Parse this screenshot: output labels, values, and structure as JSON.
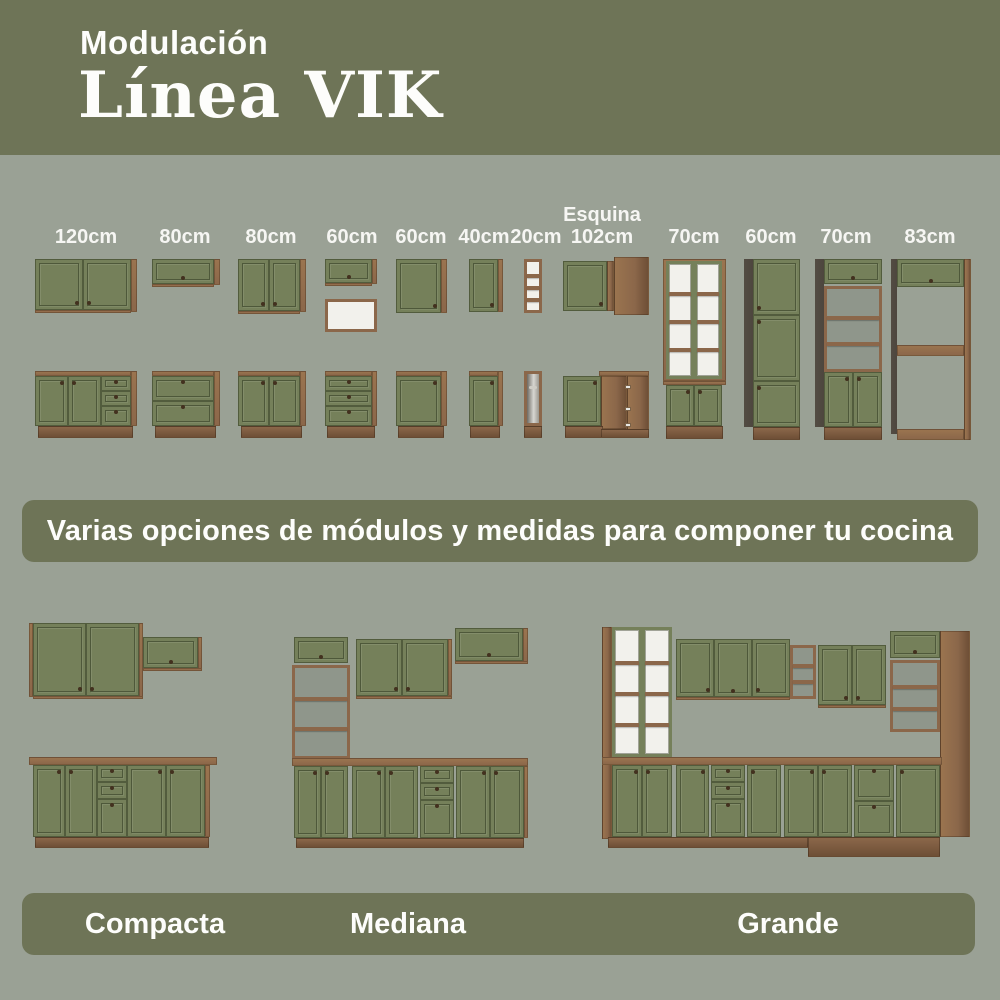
{
  "header": {
    "kicker": "Modulación",
    "title": "Línea VIK"
  },
  "modules": {
    "items": [
      {
        "label": "120cm"
      },
      {
        "label": "80cm"
      },
      {
        "label": "80cm"
      },
      {
        "label": "60cm"
      },
      {
        "label": "60cm"
      },
      {
        "label": "40cm"
      },
      {
        "label": "20cm"
      },
      {
        "label_top": "Esquina",
        "label": "102cm"
      },
      {
        "label": "70cm"
      },
      {
        "label": "60cm"
      },
      {
        "label": "70cm"
      },
      {
        "label": "83cm"
      }
    ]
  },
  "banner": {
    "text": "Varias opciones de módulos y medidas para componer tu cocina"
  },
  "compositions": [
    {
      "name": "Compacta"
    },
    {
      "name": "Mediana"
    },
    {
      "name": "Grande"
    }
  ],
  "colors": {
    "olive": "#6E7457",
    "bg": "#9AA195",
    "door": "#75805A",
    "wood": "#8B674A",
    "woodlight": "#9A744F",
    "wooddark": "#6E4F36",
    "darkside": "#4D463E",
    "paper": "#F2F1EC",
    "text": "#FDFDFB"
  }
}
